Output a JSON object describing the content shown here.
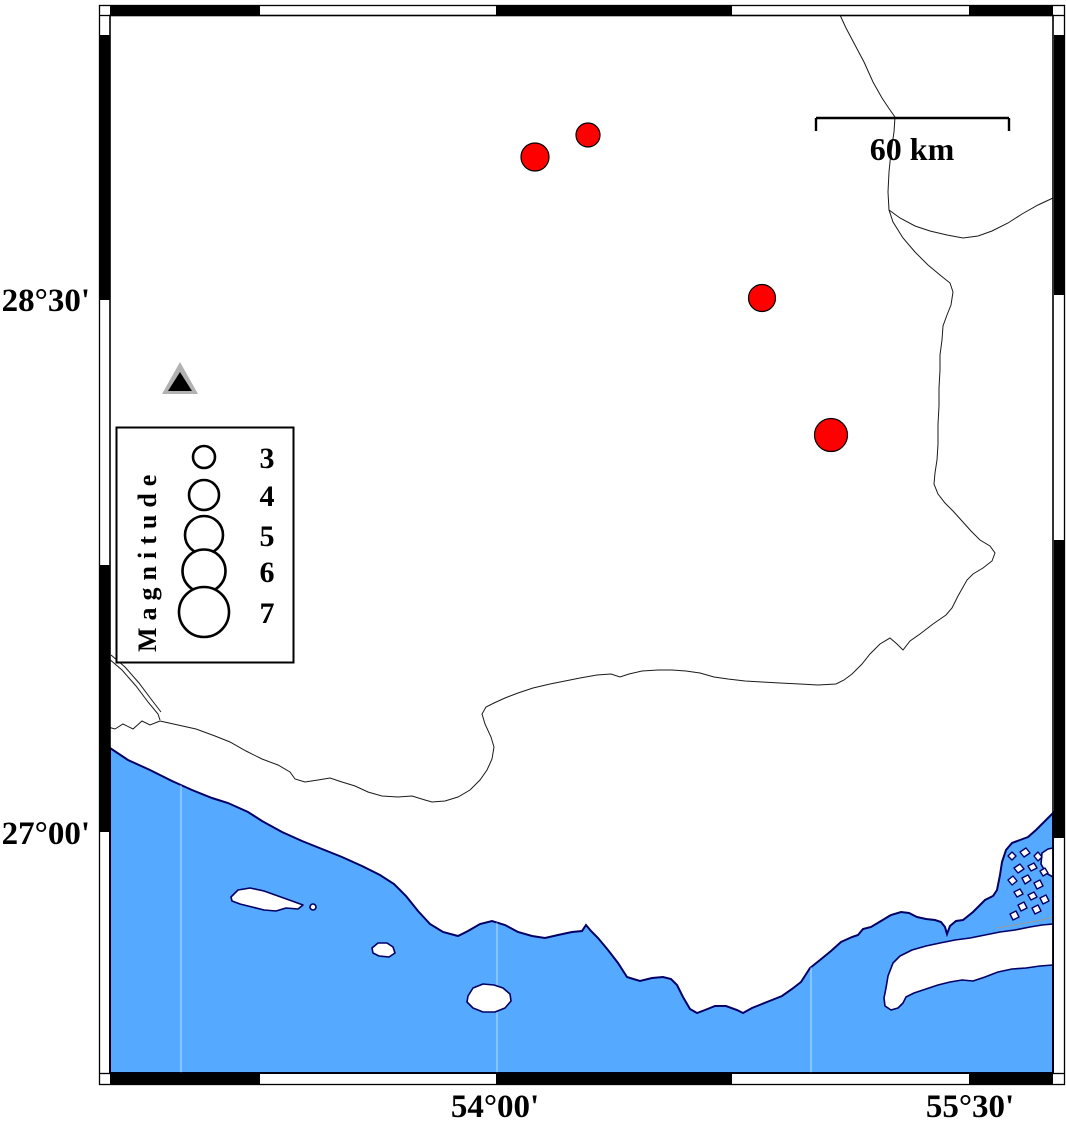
{
  "figure": {
    "type": "seismicity-map",
    "axes": {
      "left": [
        {
          "text": "28°30'",
          "y": 300
        },
        {
          "text": "27°00'",
          "y": 833
        }
      ],
      "bottom": [
        {
          "text": "54°00'",
          "x": 495
        },
        {
          "text": "55°30'",
          "x": 970
        }
      ]
    },
    "scale_bar": {
      "label": "60 km",
      "x1": 816,
      "x2": 1009,
      "y": 118,
      "tick_drop": 13
    },
    "legend": {
      "title": "Magnitude",
      "circle_cx": 204,
      "label_x": 267,
      "entries": [
        {
          "label": "3",
          "r": 11,
          "cy": 457
        },
        {
          "label": "4",
          "r": 15,
          "cy": 495
        },
        {
          "label": "5",
          "r": 19,
          "cy": 535
        },
        {
          "label": "6",
          "r": 21.5,
          "cy": 571
        },
        {
          "label": "7",
          "r": 25,
          "cy": 612
        }
      ]
    },
    "earthquakes": [
      {
        "x": 535,
        "y": 157,
        "r": 14
      },
      {
        "x": 588,
        "y": 135,
        "r": 12
      },
      {
        "x": 762,
        "y": 298,
        "r": 13.5
      },
      {
        "x": 831,
        "y": 435,
        "r": 16.5
      }
    ],
    "station": {
      "x": 180,
      "y": 380
    },
    "colors": {
      "sea": "#55aaff",
      "coastline": "#000066",
      "border_line": "#1a1a1a",
      "strait_line": "#999999",
      "earthquake_fill": "#ff0000",
      "earthquake_stroke": "#000000",
      "station_gray": "#b2b2b2",
      "station_black": "#000000",
      "frame": "#000000"
    }
  }
}
